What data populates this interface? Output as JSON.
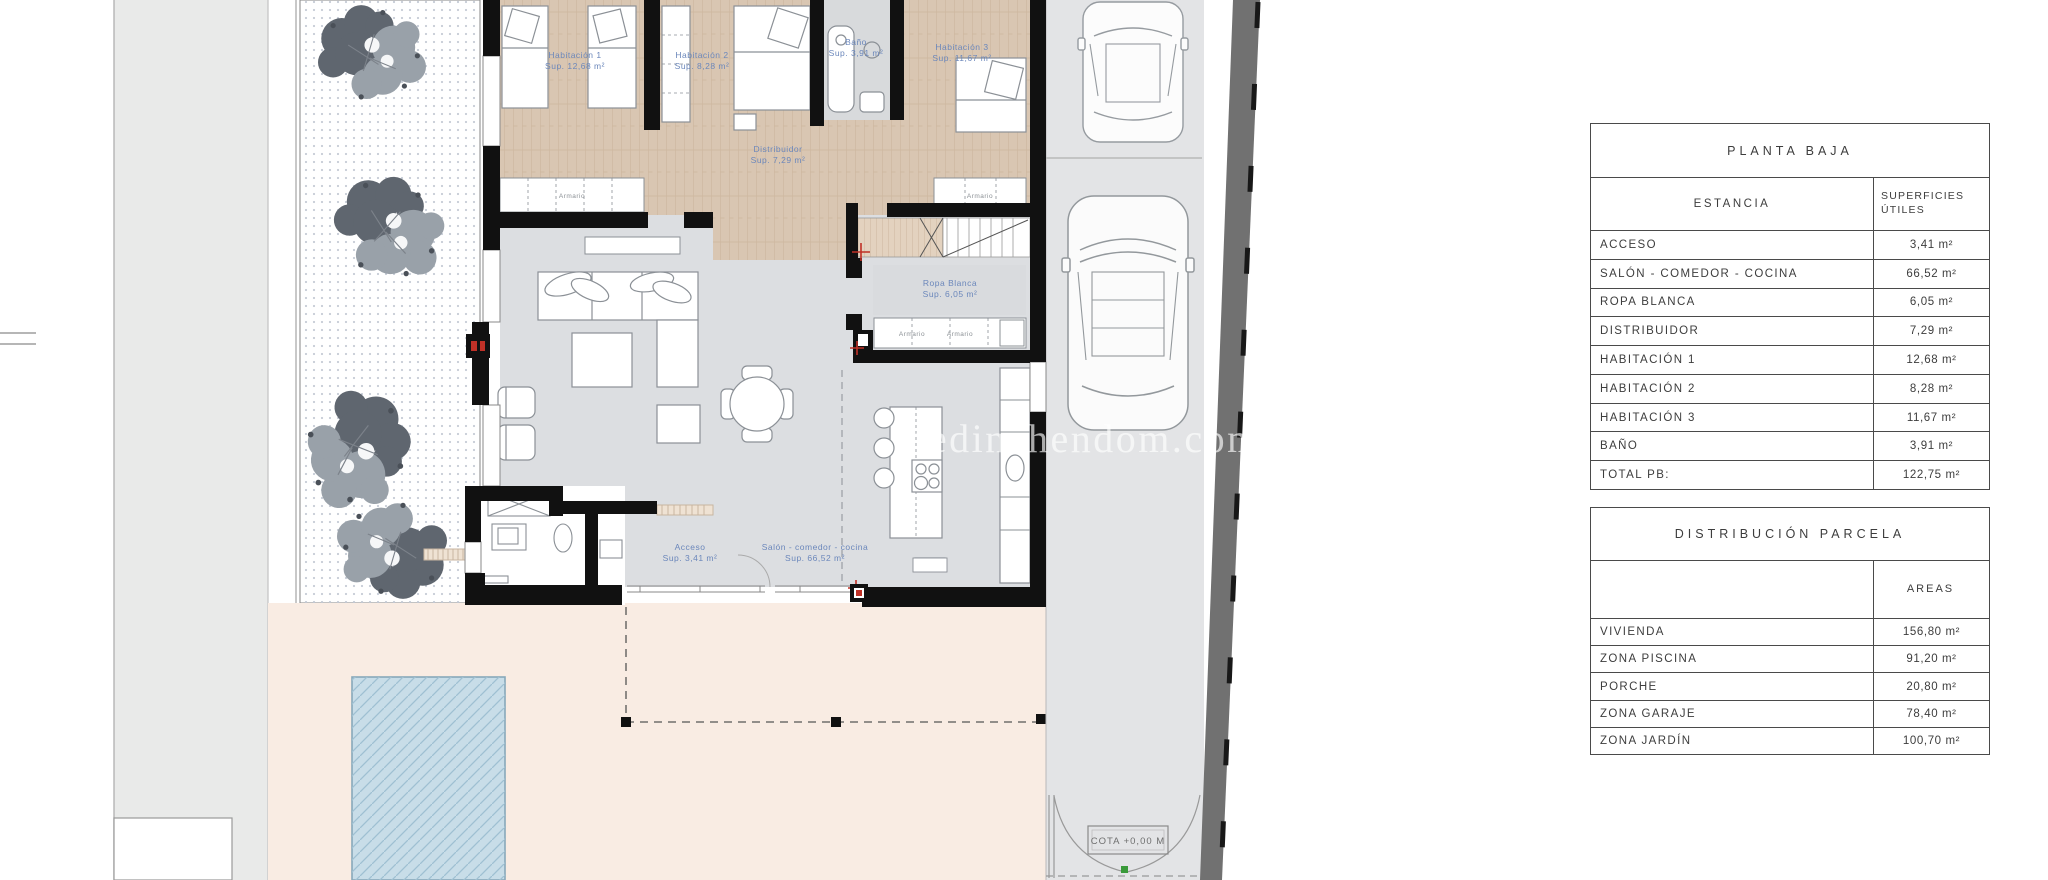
{
  "watermark": "medinahendom.com",
  "plan": {
    "rooms": [
      {
        "name": "Habitación 1",
        "sup": "Sup. 12,68 m²"
      },
      {
        "name": "Habitación 2",
        "sup": "Sup. 8,28 m²"
      },
      {
        "name": "Baño",
        "sup": "Sup. 3,91 m²"
      },
      {
        "name": "Habitación 3",
        "sup": "Sup. 11,67 m²"
      },
      {
        "name": "Distribuidor",
        "sup": "Sup. 7,29 m²"
      },
      {
        "name": "Ropa Blanca",
        "sup": "Sup. 6,05 m²"
      },
      {
        "name": "Acceso",
        "sup": "Sup. 3,41 m²"
      },
      {
        "name": "Salón - comedor - cocina",
        "sup": "Sup. 66,52 m²"
      }
    ],
    "closet_label": "Armario",
    "cota_label": "COTA +0,00 M"
  },
  "tables": {
    "planta_baja": {
      "title": "PLANTA BAJA",
      "col_room": "ESTANCIA",
      "col_area": "SUPERFICIES ÚTILES",
      "rows": [
        {
          "label": "ACCESO",
          "value": "3,41 m²"
        },
        {
          "label": "SALÓN - COMEDOR - COCINA",
          "value": "66,52 m²"
        },
        {
          "label": "ROPA BLANCA",
          "value": "6,05 m²"
        },
        {
          "label": "DISTRIBUIDOR",
          "value": "7,29 m²"
        },
        {
          "label": "HABITACIÓN 1",
          "value": "12,68 m²"
        },
        {
          "label": "HABITACIÓN 2",
          "value": "8,28 m²"
        },
        {
          "label": "HABITACIÓN 3",
          "value": "11,67 m²"
        },
        {
          "label": "BAÑO",
          "value": "3,91 m²"
        },
        {
          "label": "TOTAL PB:",
          "value": "122,75 m²"
        }
      ]
    },
    "distribucion_parcela": {
      "title": "DISTRIBUCIÓN PARCELA",
      "col_area": "AREAS",
      "rows": [
        {
          "label": "VIVIENDA",
          "value": "156,80 m²"
        },
        {
          "label": "ZONA PISCINA",
          "value": "91,20 m²"
        },
        {
          "label": "PORCHE",
          "value": "20,80 m²"
        },
        {
          "label": "ZONA GARAJE",
          "value": "78,40 m²"
        },
        {
          "label": "ZONA JARDÍN",
          "value": "100,70 m²"
        }
      ]
    }
  },
  "colors": {
    "wall_black": "#111111",
    "room_label_blue": "#6b87bb",
    "terrace_pink": "#f9ece3",
    "pool_blue": "#c8dde8",
    "wood_floor": "#d9c6b2",
    "living_gray": "#dcdee1",
    "road_gray": "#717171"
  }
}
